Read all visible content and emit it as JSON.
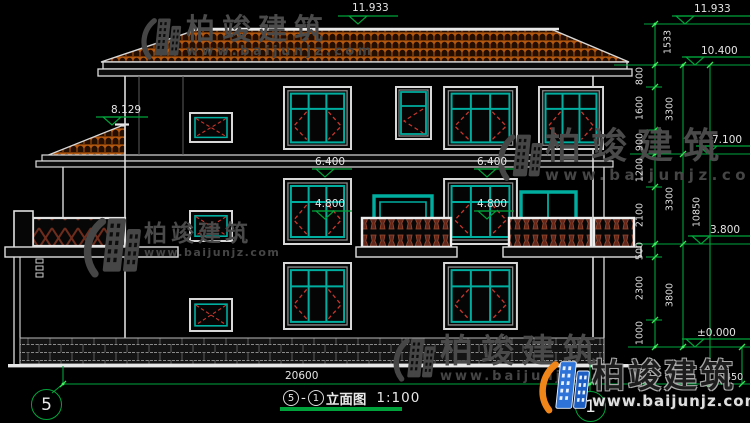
{
  "title_block": {
    "axis_start": "5",
    "axis_end": "1",
    "separator": "-",
    "name": "立面图",
    "scale": "1:100"
  },
  "axes": {
    "left": "5",
    "right": "1"
  },
  "levels": {
    "ridge": "11.933",
    "ridge_right": "11.933",
    "eave": "10.400",
    "wing_roof": "8.129",
    "floor3": "7.100",
    "floor3_mid_a": "6.400",
    "floor3_mid_b": "6.400",
    "floor2_win_a": "4.800",
    "floor2_win_b": "4.800",
    "floor2": "3.800",
    "ground": "±0.000"
  },
  "dims": {
    "ridge_to_eave": "1533",
    "seg": [
      "800",
      "1600",
      "900",
      "1200",
      "2100",
      "500",
      "2300",
      "1000"
    ],
    "floors": [
      "3300",
      "3300",
      "3800"
    ],
    "total_height": "10850",
    "overall_width": "20600",
    "plinth": "450"
  },
  "watermark": {
    "name": "柏竣建筑",
    "url": "www.baijunjz.com"
  },
  "brand": {
    "name": "柏竣建筑",
    "url": "www.baijunjz.com"
  }
}
